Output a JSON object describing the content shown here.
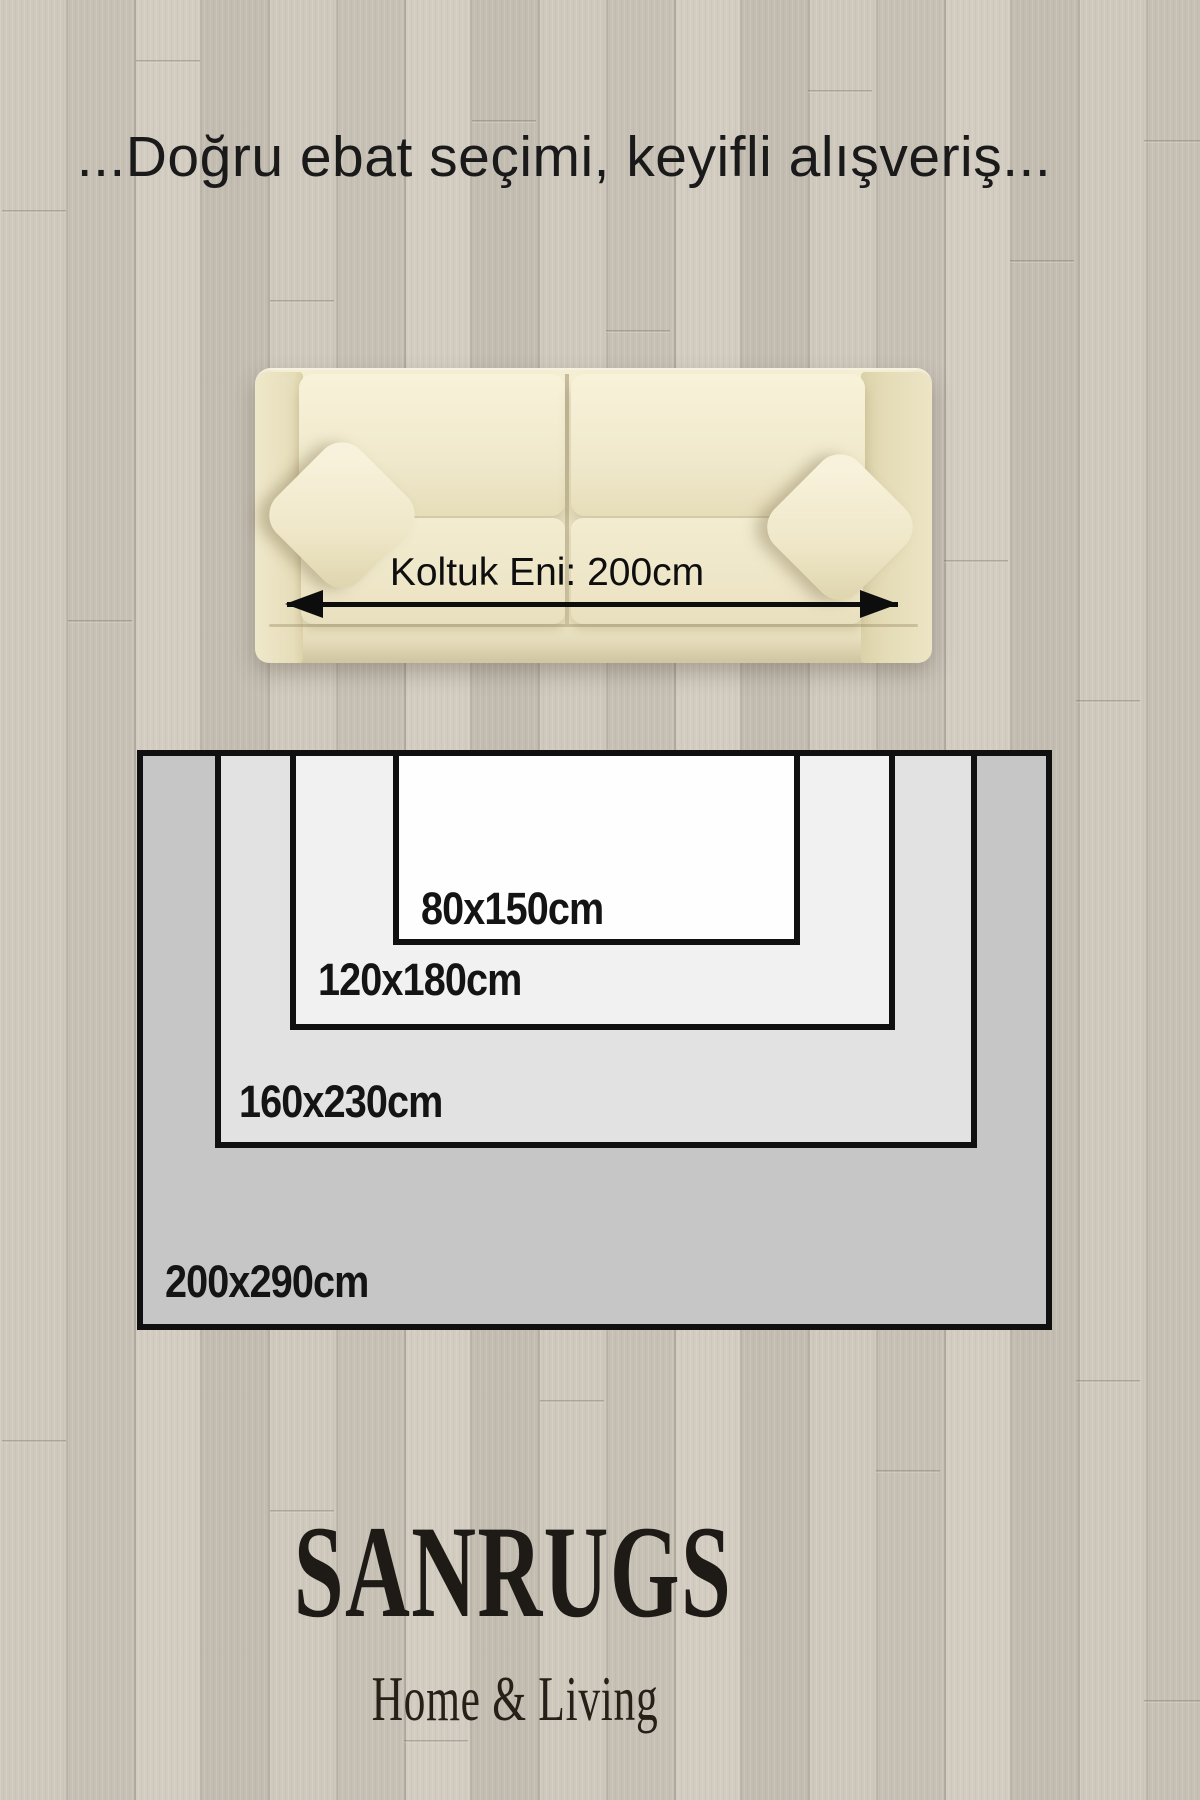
{
  "header": {
    "title": "...Doğru ebat seçimi, keyifli alışveriş..."
  },
  "sofa": {
    "width_label": "Koltuk Eni: 200cm",
    "width_cm": 200
  },
  "rug_sizes": [
    {
      "label": "200x290cm",
      "width_cm": 200,
      "length_cm": 290
    },
    {
      "label": "160x230cm",
      "width_cm": 160,
      "length_cm": 230
    },
    {
      "label": "120x180cm",
      "width_cm": 120,
      "length_cm": 180
    },
    {
      "label": "80x150cm",
      "width_cm": 80,
      "length_cm": 150
    }
  ],
  "brand": {
    "name": "SANRUGS",
    "tagline": "Home & Living"
  },
  "colors": {
    "floor": "#c9c2b7",
    "sofa": "#efe8ca",
    "rug_border": "#101010",
    "rug_fills": [
      "#c6c6c6",
      "#e2e2e2",
      "#f1f1f1",
      "#fefefe"
    ],
    "text": "#141414"
  }
}
